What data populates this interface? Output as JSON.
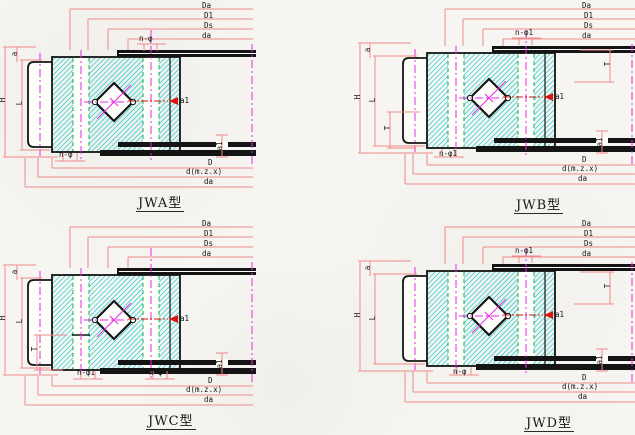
{
  "page": {
    "background": "#f6f5f1"
  },
  "colors": {
    "dim_line": "#f08a8a",
    "outline": "#141414",
    "hatch": "#38d2d2",
    "centerline": "#e82ae8",
    "section_red": "#dd1414",
    "green_dash": "#00a84e",
    "fill_white": "#fdfdfa"
  },
  "quadrants": [
    {
      "id": "JWA",
      "caption": "JWA型",
      "top_dims": [
        "Da",
        "D1",
        "Ds",
        "da"
      ],
      "bottom_dims": [
        "D",
        "d(m.z.x)",
        "da"
      ],
      "dim_height": "H",
      "dim_inner_height": "L",
      "dim_a": "a",
      "dim_a1": "a1",
      "arrow_label": "a1",
      "callout_top": "n-φ",
      "callout_bottom": "n-φ"
    },
    {
      "id": "JWB",
      "caption": "JWB型",
      "top_dims": [
        "Da",
        "D1",
        "Ds",
        "da"
      ],
      "bottom_dims": [
        "D",
        "d(m.z.x)",
        "da"
      ],
      "dim_height": "H",
      "dim_inner_height": "L",
      "dim_a": "a",
      "dim_t_left": "T",
      "dim_t_right": "T",
      "dim_a1": "a1",
      "arrow_label": "a1",
      "callout_top": "n-φ1",
      "callout_bottom": "n-φ1"
    },
    {
      "id": "JWC",
      "caption": "JWC型",
      "top_dims": [
        "Da",
        "D1",
        "Ds",
        "da"
      ],
      "bottom_dims": [
        "D",
        "d(m.z.x)",
        "da"
      ],
      "dim_height": "H",
      "dim_inner_height": "L",
      "dim_a": "a",
      "dim_t_left": "T",
      "dim_a1": "a1",
      "arrow_label": "a1",
      "callout_bottom": "n-φ1",
      "callout_bottom2": "n-φ"
    },
    {
      "id": "JWD",
      "caption": "JWD型",
      "top_dims": [
        "Da",
        "D1",
        "Ds",
        "da"
      ],
      "bottom_dims": [
        "D",
        "d(m.z.x)",
        "da"
      ],
      "dim_height": "H",
      "dim_inner_height": "L",
      "dim_a": "a",
      "dim_t_right": "T",
      "dim_a1": "a1",
      "arrow_label": "a1",
      "callout_top": "n-φ1",
      "callout_bottom": "n-φ"
    }
  ]
}
